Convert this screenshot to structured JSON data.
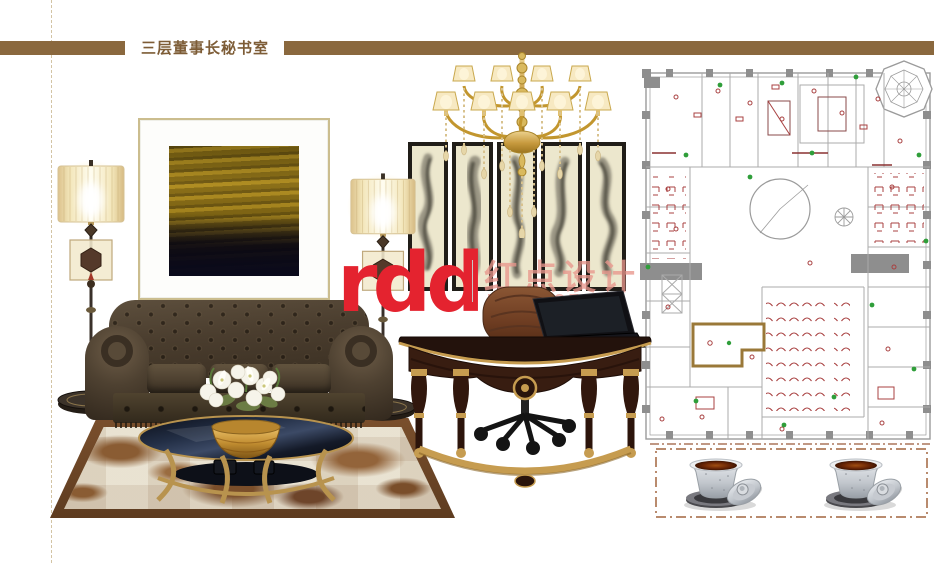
{
  "header": {
    "title": "三层董事长秘书室"
  },
  "watermark": {
    "logo_text": "rdd",
    "cn_text": "红点设计",
    "en_text": "RED DOT"
  },
  "palette": {
    "header_bar_brown": "#8a683e",
    "header_title_brown": "#7d5c36",
    "logo_red": "#e4232f",
    "watermark_pink": "#e69b93",
    "gold_accent": "#c19a52",
    "sofa_leather": "#483c2e",
    "desk_mahogany": "#381d11",
    "panel_cream": "#ece7cd",
    "rug_border_brown": "#6b4526",
    "plan_line_gray": "#9b9b9b",
    "plan_symbol_red": "#a84040",
    "plan_symbol_green": "#2f9e3a",
    "plan_room_highlight": "#9a7838",
    "tea_brown": "#6b2606"
  },
  "moodboard_items": [
    "floor-lamp-left",
    "abstract-gold-painting",
    "crystal-chandelier",
    "wall-art-panels",
    "floor-lamp-right",
    "chesterfield-sofa",
    "lily-bouquet-coffee-table",
    "cowhide-patchwork-rug",
    "crescent-executive-desk",
    "office-chair",
    "laptop",
    "floor-plan",
    "tea-cup-pair"
  ]
}
